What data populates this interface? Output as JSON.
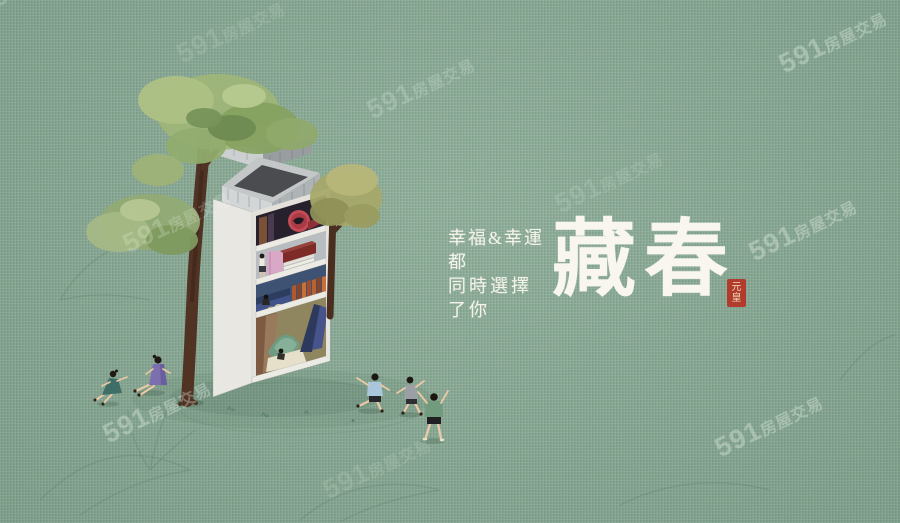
{
  "poster": {
    "title": "藏春",
    "tagline_lines": [
      "幸福&幸運",
      "都",
      "同時選擇",
      "了你"
    ],
    "seal_text": "元皇",
    "colors": {
      "background": "#7fa28c",
      "title_text": "#f8f6ee",
      "tagline_text": "#f4f2e9",
      "seal_red": "#b13c2b",
      "foliage_green": "#93ab74",
      "trunk_brown": "#503323",
      "concrete_gray": "#c8cbcd"
    }
  },
  "watermark": {
    "number": "591",
    "suffix": "房屋交易"
  }
}
